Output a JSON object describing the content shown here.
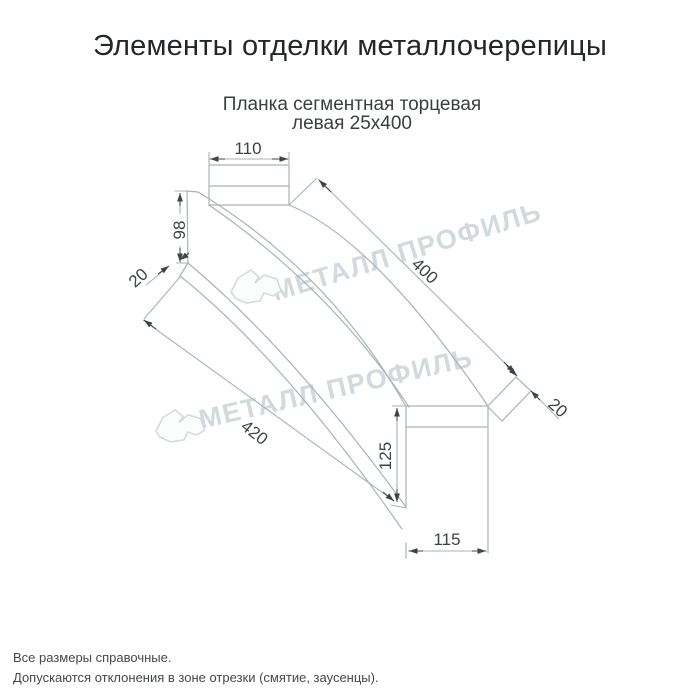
{
  "header": {
    "title": "Элементы отделки металлочерепицы"
  },
  "drawing": {
    "subtitle_line1": "Планка сегментная торцевая",
    "subtitle_line2": "левая 25х400",
    "dimensions": {
      "top_width": "110",
      "left_end_height": "98",
      "left_flange": "20",
      "length_top": "400",
      "length_bottom": "420",
      "right_flange": "20",
      "end_height": "125",
      "end_width": "115"
    },
    "watermark": {
      "text": "МЕТАЛЛ ПРОФИЛЬ",
      "logo": "metall-profil-logo"
    },
    "colors": {
      "object_line": "#a9b2ba",
      "dimension_mark": "#3f4449",
      "label_text": "#3d4247",
      "watermark": "#d4d9dd",
      "background": "#ffffff"
    }
  },
  "footer": {
    "note1": "Все размеры справочные.",
    "note2": "Допускаются отклонения в зоне отрезки (смятие, заусенцы)."
  }
}
